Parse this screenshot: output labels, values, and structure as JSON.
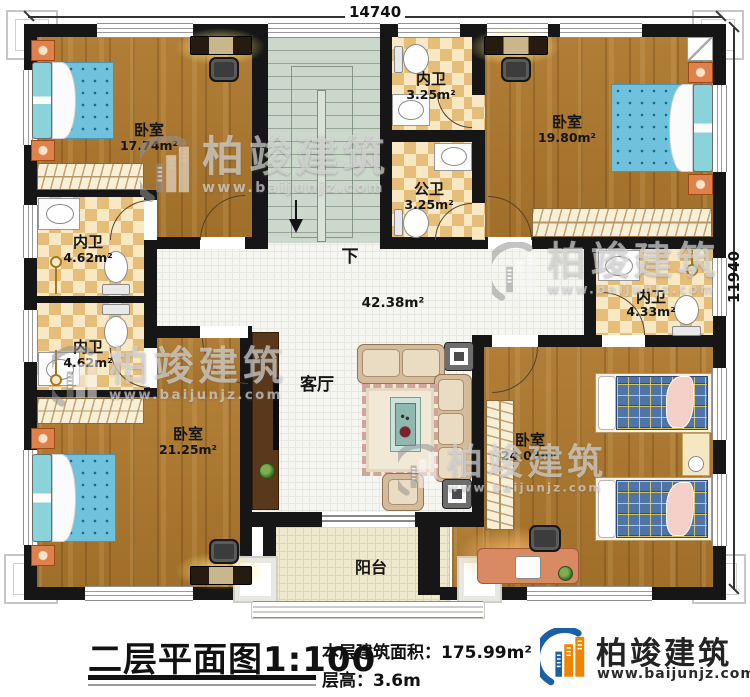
{
  "plan": {
    "dim_top": "14740",
    "dim_right": "11940",
    "stair_down": "下",
    "rooms": [
      {
        "label": "卧室",
        "area": "17.74m²"
      },
      {
        "label": "内卫",
        "area": "4.62m²"
      },
      {
        "label": "内卫",
        "area": "4.62m²"
      },
      {
        "label": "卧室",
        "area": "21.25m²"
      },
      {
        "label": "内卫",
        "area": "3.25m²"
      },
      {
        "label": "公卫",
        "area": "3.25m²"
      },
      {
        "label": "卧室",
        "area": "19.80m²"
      },
      {
        "label": "内卫",
        "area": "4.33m²"
      },
      {
        "label": "卧室",
        "area": "24.08m²"
      },
      {
        "label": "客厅",
        "area": "42.38m²"
      },
      {
        "label": "阳台",
        "area": ""
      }
    ]
  },
  "footer": {
    "title": "二层平面图1:100",
    "area_label": "本层建筑面积：",
    "area_value": "175.99m²",
    "height_label": "层高：",
    "height_value": "3.6m"
  },
  "branding": {
    "name": "柏竣建筑",
    "url": "www.baijunjz.com"
  },
  "colors": {
    "wall": "#161616",
    "wood": "#ac772c",
    "checker_a": "#e7bd7a",
    "checker_b": "#f8e9c4",
    "tile": "#f5f5f2",
    "stair": "#ccd8cb",
    "balcony": "#eee9cd",
    "bed_blue": "#70c2dc",
    "plaid_blue": "#4e74a8",
    "logo_blue": "#1a5fa8",
    "logo_orange": "#f08300"
  }
}
